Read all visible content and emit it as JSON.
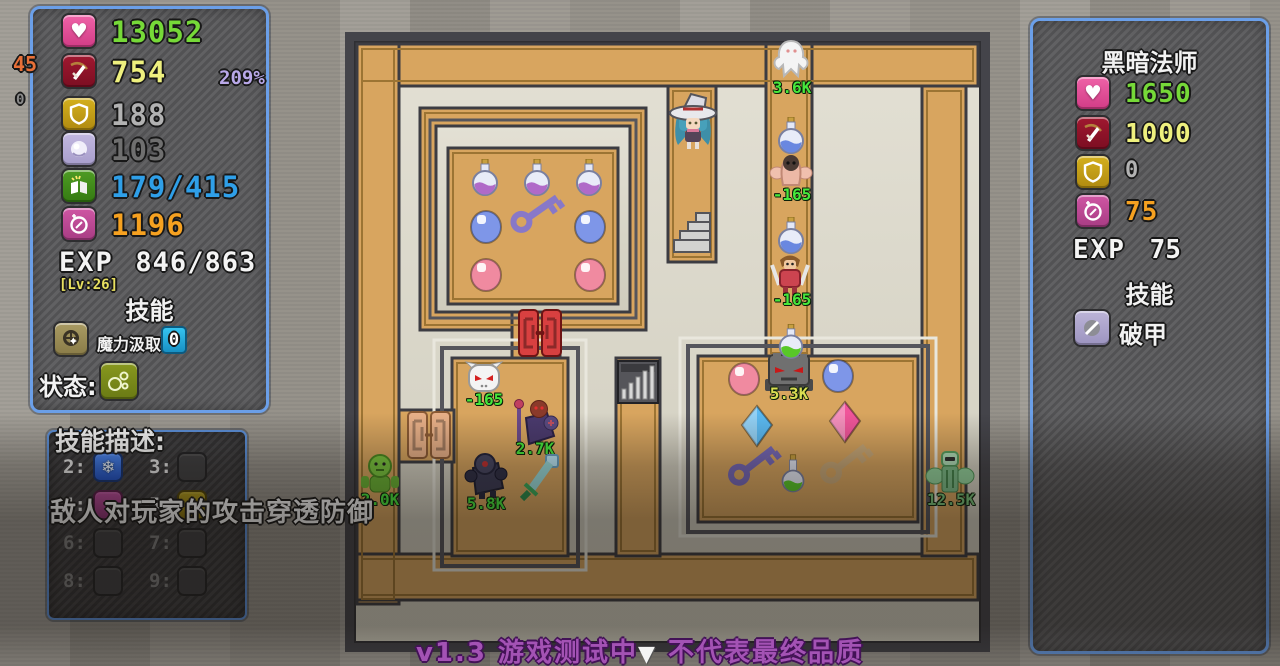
{
  "player_panel": {
    "stats": [
      {
        "icon": "heart-icon",
        "value": "13052",
        "color": "#76d938"
      },
      {
        "icon": "attack-icon",
        "value": "754",
        "color": "#eef07e"
      },
      {
        "icon": "shield-icon",
        "value": "188",
        "color": "#b2b2b2"
      },
      {
        "icon": "orb-icon",
        "value": "103",
        "color": "#6f6f6f"
      },
      {
        "icon": "book-icon",
        "value": "179/415",
        "color": "#2f9fe8"
      },
      {
        "icon": "coin-icon",
        "value": "1196",
        "color": "#f6a120"
      }
    ],
    "side_notes": {
      "attack_add": "45",
      "defense_add": "0",
      "attack_multiplier": "209%"
    },
    "exp_label": "EXP",
    "exp_value": "846/863",
    "level": "[Lv:26]",
    "skills_title": "技能",
    "skill": {
      "icon": "mana-drain-icon",
      "name": "魔力汲取",
      "count": "0"
    },
    "status_label": "状态:",
    "status_icon": "bubbles-icon"
  },
  "enemy_panel": {
    "name": "黑暗法师",
    "stats": [
      {
        "icon": "heart-icon",
        "value": "1650",
        "color": "#76d938"
      },
      {
        "icon": "attack-icon",
        "value": "1000",
        "color": "#eef07e"
      },
      {
        "icon": "shield-icon",
        "value": "0",
        "color": "#b2b2b2"
      },
      {
        "icon": "coin-icon",
        "value": "75",
        "color": "#f6a120"
      }
    ],
    "exp_label": "EXP",
    "exp_value": "75",
    "skills_title": "技能",
    "skill": {
      "icon": "armor-break-icon",
      "name": "破甲"
    }
  },
  "skill_panel": {
    "title": "技能描述:",
    "description": "敌人对玩家的攻击穿透防御",
    "slots": [
      {
        "label": "2:",
        "icon": "frost-icon"
      },
      {
        "label": "3:",
        "icon": ""
      },
      {
        "label": "4:",
        "icon": "magenta-skill-icon"
      },
      {
        "label": "5:",
        "icon": "gold-skill-icon"
      },
      {
        "label": "6:",
        "icon": ""
      },
      {
        "label": "7:",
        "icon": ""
      },
      {
        "label": "8:",
        "icon": ""
      },
      {
        "label": "9:",
        "icon": ""
      }
    ]
  },
  "maze": {
    "labels": [
      {
        "id": "ghost-hp",
        "text": "3.6K"
      },
      {
        "id": "fleshy-damage",
        "text": "-165"
      },
      {
        "id": "warrior-damage",
        "text": "-165"
      },
      {
        "id": "skull-damage",
        "text": "-165"
      },
      {
        "id": "mage-hp",
        "text": "2.7K"
      },
      {
        "id": "knight-hp",
        "text": "5.8K"
      },
      {
        "id": "goblin-hp",
        "text": "2.0K"
      },
      {
        "id": "golem-hp",
        "text": "5.3K"
      },
      {
        "id": "green-armor-hp",
        "text": "12.5K"
      }
    ]
  },
  "footer": {
    "left": "v1.3 游戏测试中",
    "arrow": "▼",
    "right": "不代表最终品质"
  }
}
